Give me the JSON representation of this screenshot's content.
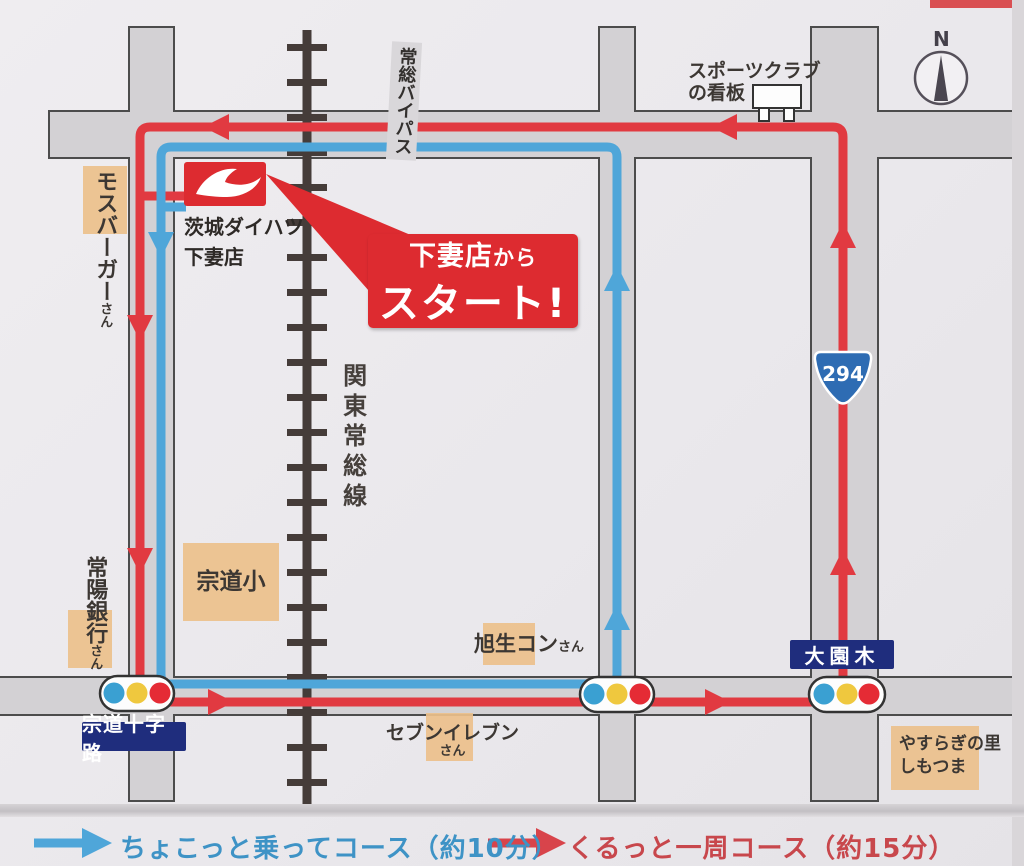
{
  "store": {
    "name_line1": "茨城ダイハツ",
    "name_line2": "下妻店"
  },
  "callout": {
    "line1_main": "下妻店",
    "line1_suffix": "から",
    "line2": "スタート!"
  },
  "roads": {
    "bypass_label": "常総バイパス",
    "railway_label": "関東常総線",
    "route_badge": "294"
  },
  "compass": {
    "label": "N"
  },
  "landmarks": {
    "sports_club": {
      "line1": "スポーツクラブ",
      "line2": "の看板"
    },
    "mos_burger": {
      "name": "モスバーガー",
      "suffix": "さん"
    },
    "joyo_bank": {
      "name": "常陽銀行",
      "suffix": "さん"
    },
    "sodo_elementary": {
      "name": "宗道小"
    },
    "asahi_concrete": {
      "name": "旭生コン",
      "suffix": "さん"
    },
    "seven_eleven": {
      "name": "セブンイレブン",
      "suffix": "さん"
    },
    "yasuragi": {
      "line1": "やすらぎの里",
      "line2": "しもつま"
    }
  },
  "signs": {
    "sodo_crossroads": "宗道十字路",
    "ozonoki": "大園木"
  },
  "legend": {
    "short_course": {
      "label": "ちょこっと乗ってコース（約10分）",
      "color": "#3e93c6"
    },
    "loop_course": {
      "label": "くるっと一周コース（約15分）",
      "color": "#c8474c"
    }
  },
  "colors": {
    "route_short_blue": "#4fa6d9",
    "route_loop_red": "#e13a41",
    "road_fill": "#d3d1d4",
    "label_box_tan": "#ecc08b",
    "sign_navy": "#1f2d7d",
    "brand_red": "#dd2b30",
    "traffic_light_blue": "#3aa0d2",
    "traffic_light_yellow": "#efc83e",
    "traffic_light_red": "#e52b35",
    "badge_blue": "#2e6cb3"
  }
}
